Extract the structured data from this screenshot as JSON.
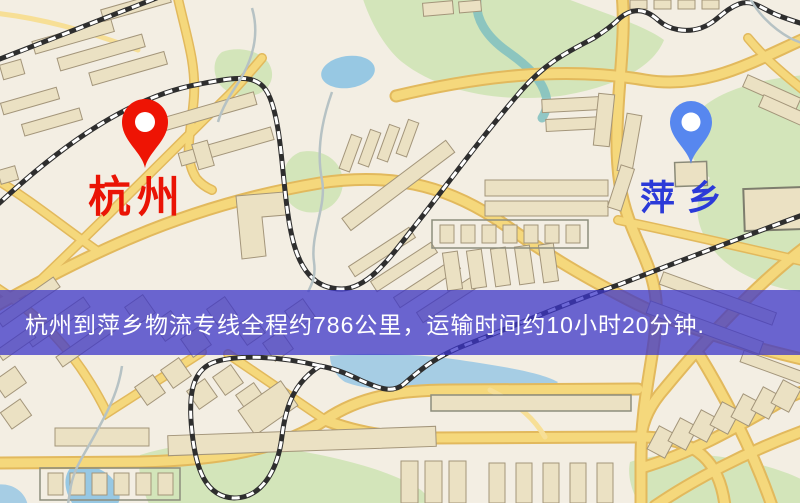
{
  "map": {
    "origin": {
      "name": "杭州",
      "label_color": "#ea1405",
      "pin_color": "#ee1404"
    },
    "destination": {
      "name": "萍乡",
      "label_color": "#2b3ad8",
      "pin_color": "#5787ef"
    }
  },
  "banner": {
    "text": "杭州到萍乡物流专线全程约786公里，运输时间约10小时20分钟.",
    "bg_color": "rgba(60,53,200,0.75)",
    "text_color": "#ffffff"
  },
  "map_colors": {
    "background": "#f3eee3",
    "road_fill": "#f5d87c",
    "road_casing": "#e2b95d",
    "park": "#d3e5ba",
    "water": "#97c8e3",
    "building": "#ebe1c3",
    "railway": "#2e2e2e"
  }
}
